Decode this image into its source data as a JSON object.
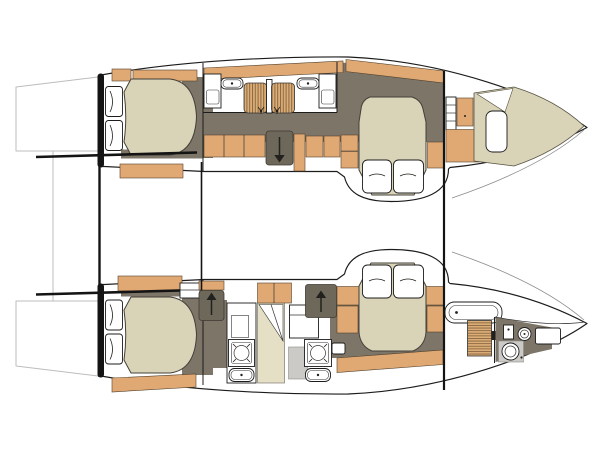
{
  "diagram": {
    "type": "boat-floor-plan",
    "subject": "catamaran interior deck plan, top-down view, bows pointing right",
    "visible_text": [],
    "hull_count": 2,
    "double_cabins": 4
  },
  "colors": {
    "background": "#ffffff",
    "outline": "#1c1c1c",
    "stern_bar": "#141414",
    "wood": "#e0a974",
    "wood_light": "#dcae77",
    "slat_line": "#8a6742",
    "floor": "#7d7568",
    "floor_dark": "#6e685b",
    "mattress": "#d9d3b8",
    "beige_panel": "#e5dfc6",
    "gray_floor": "#cbcac7",
    "platform_line": "#bdbdbd",
    "sheer_line": "#8b8b8b"
  },
  "fixtures": {
    "double_beds": 4,
    "pillows_per_bed": 2,
    "toilets": 5,
    "sink_basins": 5,
    "shower_trays": 3,
    "swim_platforms": 2,
    "companionway_arrows": [
      {
        "hull": "top",
        "direction": "down"
      },
      {
        "hull": "bottom",
        "position": "aft",
        "direction": "up"
      },
      {
        "hull": "bottom",
        "position": "forward",
        "direction": "up"
      }
    ]
  }
}
